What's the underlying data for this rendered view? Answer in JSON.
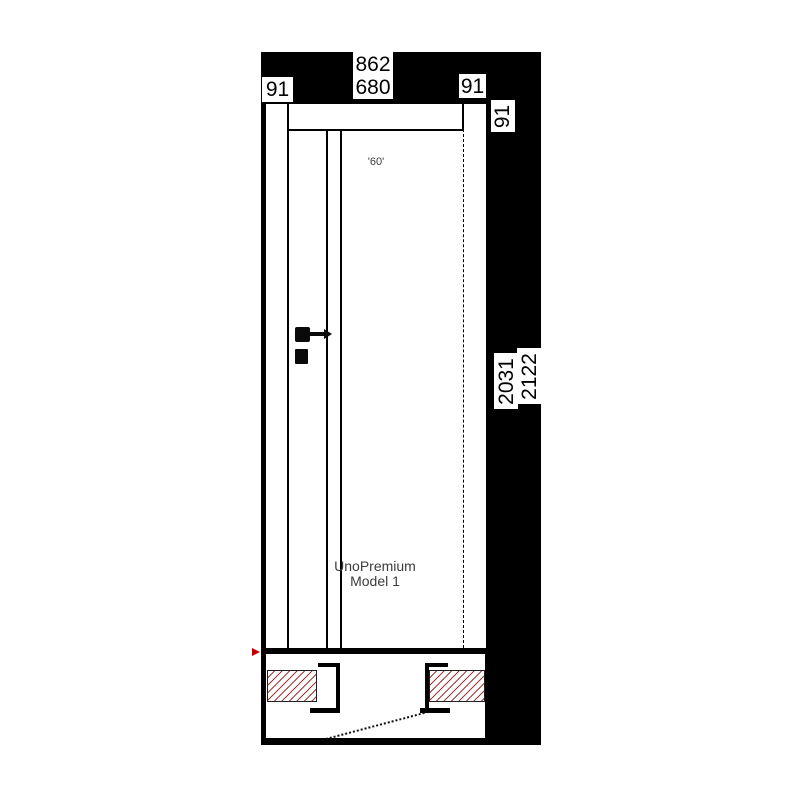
{
  "view": {
    "title": "door-technical-drawing",
    "product": {
      "name": "UnoPremium",
      "model": "Model 1",
      "glass_label": "'60'"
    },
    "dimensions": {
      "frame_outer_width": "862",
      "leaf_width": "680",
      "frame_left": "91",
      "frame_right": "91",
      "frame_top": "91",
      "leaf_height": "2031",
      "frame_outer_height": "2122"
    },
    "colors": {
      "background": "#000000",
      "surface": "#ffffff",
      "hatch_red": "#a03a3a",
      "marker_red": "#c00000",
      "text_gray": "#3c3c3c"
    }
  }
}
